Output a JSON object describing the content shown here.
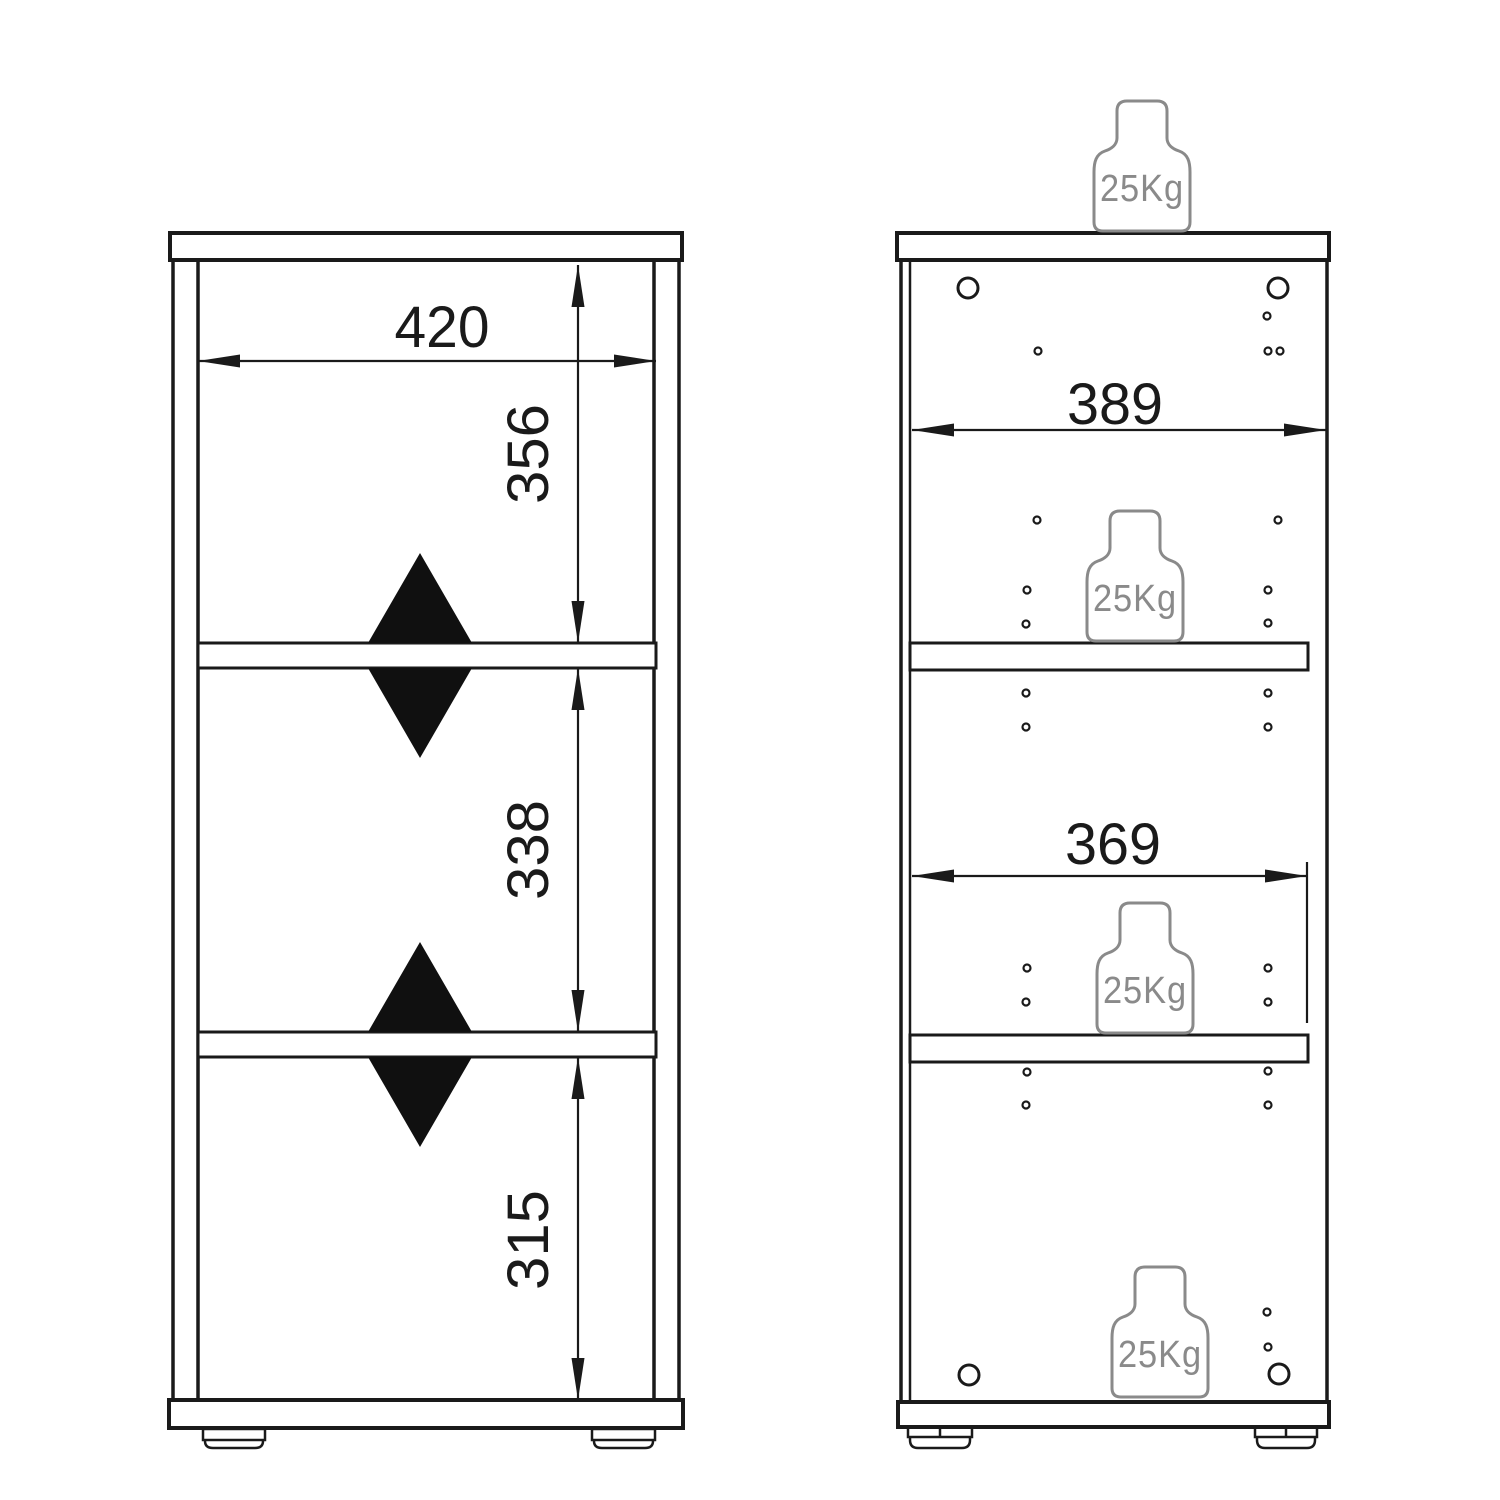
{
  "front_view": {
    "inner_width": "420",
    "top_section_height": "356",
    "middle_section_height": "338",
    "bottom_section_height": "315"
  },
  "section_view": {
    "inner_width": "389",
    "shelf_width": "369",
    "max_load_top": "25Kg",
    "max_load_upper_shelf": "25Kg",
    "max_load_lower_shelf": "25Kg",
    "max_load_bottom": "25Kg"
  }
}
